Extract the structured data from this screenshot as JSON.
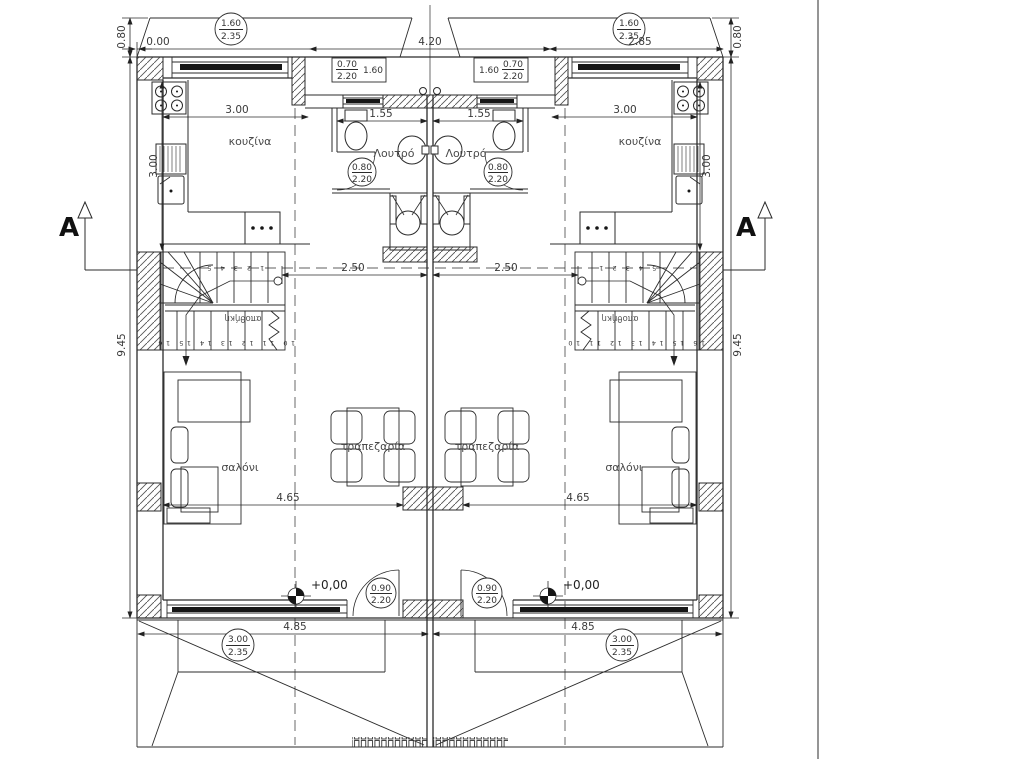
{
  "labels": {
    "kitchen": "κουζίνα",
    "bathroom": "Λουτρό",
    "living_room": "σαλόνι",
    "dining_room": "τραπεζαρία",
    "storage_under_stairs": "αποθήκη",
    "floor_level": "+0,00",
    "section_mark": "A"
  },
  "dimensions": {
    "zero_offset": "0.00",
    "entry_porch_width": "4.20",
    "kitchen_front_width": "2.85",
    "canopy_depth": "0.80",
    "building_side": "9.45",
    "kitchen_width": "3.00",
    "kitchen_depth": "3.00",
    "bathroom_width": "1.55",
    "hall_width": "2.50",
    "living_width": "4.65",
    "unit_front_width": "4.85"
  },
  "openings": {
    "balcony_door": {
      "width": "1.60",
      "height": "2.35"
    },
    "kitchen_window": {
      "width": "0.70",
      "height": "2.20",
      "length": "1.60"
    },
    "bathroom_door": {
      "width": "0.80",
      "height": "2.20"
    },
    "entry_door": {
      "width": "0.90",
      "height": "2.20"
    },
    "garage_door": {
      "width": "3.00",
      "height": "2.35"
    }
  },
  "stairs": {
    "left_unit": {
      "upper_steps": "1 2 3 4 5",
      "lower_steps": "10 11 12 13 14 15 16"
    },
    "right_unit": {
      "upper_steps": "5 4 3 2 1",
      "lower_steps": "16 15 14 13 12 11 10"
    }
  }
}
